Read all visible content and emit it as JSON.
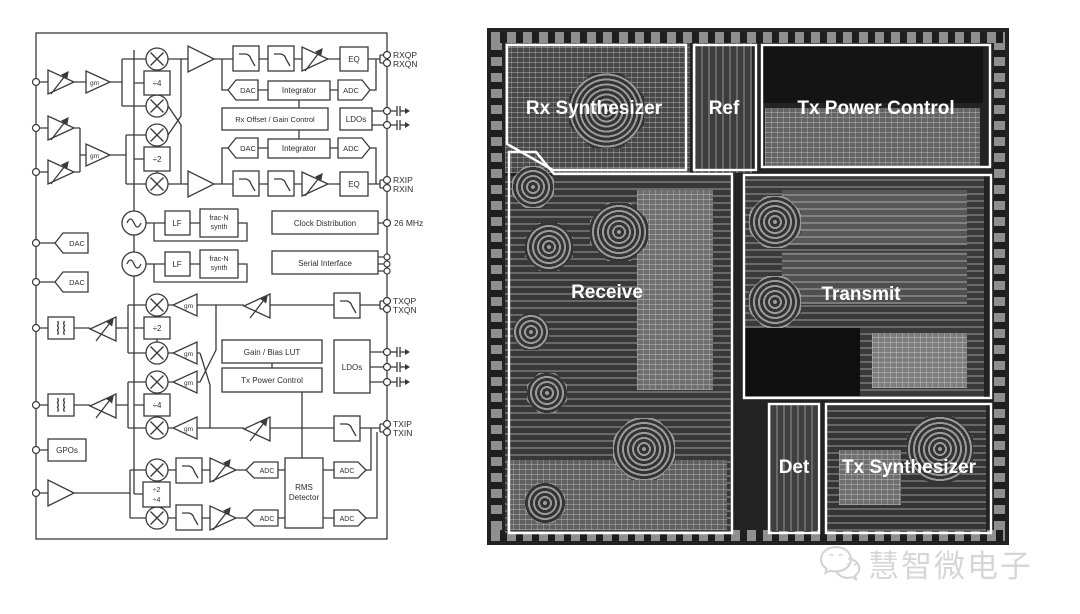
{
  "diagram": {
    "pins": {
      "rxqp": "RXQP",
      "rxqn": "RXQN",
      "rxip": "RXIP",
      "rxin": "RXIN",
      "clk26": "26 MHz",
      "txqp": "TXQP",
      "txqn": "TXQN",
      "txip": "TXIP",
      "txin": "TXIN"
    },
    "blocks": {
      "gm": "gm",
      "div4": "÷4",
      "div2": "÷2",
      "div2b": "÷2",
      "div4b": "÷4",
      "eq": "EQ",
      "dac": "DAC",
      "adc": "ADC",
      "integrator": "Integrator",
      "rx_offset_gain": "Rx Offset / Gain Control",
      "ldos": "LDOs",
      "lf": "LF",
      "fracn1": "frac-N",
      "fracn2": "synth",
      "clock_distribution": "Clock Distribution",
      "serial_interface": "Serial Interface",
      "gain_bias_lut": "Gain / Bias LUT",
      "tx_power_control": "Tx Power Control",
      "gpos": "GPOs",
      "rms1": "RMS",
      "rms2": "Detector"
    }
  },
  "die": {
    "regions": {
      "rx_synthesizer": "Rx Synthesizer",
      "ref": "Ref",
      "tx_power_control": "Tx Power Control",
      "receive": "Receive",
      "transmit": "Transmit",
      "det": "Det",
      "tx_synthesizer": "Tx Synthesizer"
    }
  },
  "watermark": {
    "brand": "慧智微电子"
  },
  "colors": {
    "line": "#3a3a3a",
    "die_bg": "#232323",
    "region_outline": "#ffffff",
    "watermark": "#d6d6d6"
  }
}
